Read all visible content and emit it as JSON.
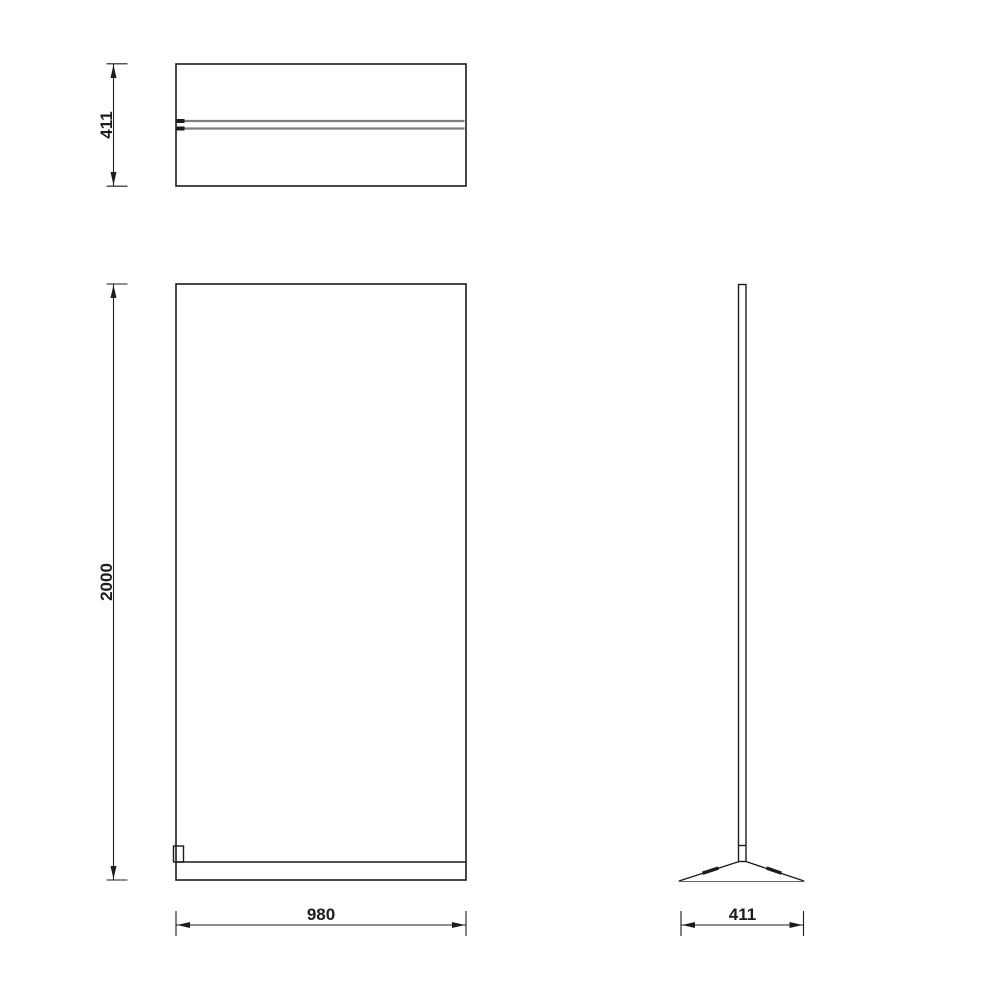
{
  "page": {
    "background": "#ffffff"
  },
  "colors": {
    "page-bg": "#ffffff",
    "line": "#1c1c1c",
    "panel-gray": "#7d7d7d",
    "baseline-gray": "#666666"
  },
  "drawing": {
    "views": {
      "top_view": {
        "name": "top view (plan)"
      },
      "front_view": {
        "name": "front view (elevation)"
      },
      "side_view": {
        "name": "side view with foot"
      }
    },
    "dimensions": {
      "top_depth": {
        "value": "411",
        "orientation": "vertical",
        "applies_to": "top view depth"
      },
      "height": {
        "value": "2000",
        "orientation": "vertical",
        "applies_to": "front view height"
      },
      "width": {
        "value": "980",
        "orientation": "horizontal",
        "applies_to": "front view width"
      },
      "base_depth": {
        "value": "411",
        "orientation": "horizontal",
        "applies_to": "side view base depth"
      }
    }
  }
}
